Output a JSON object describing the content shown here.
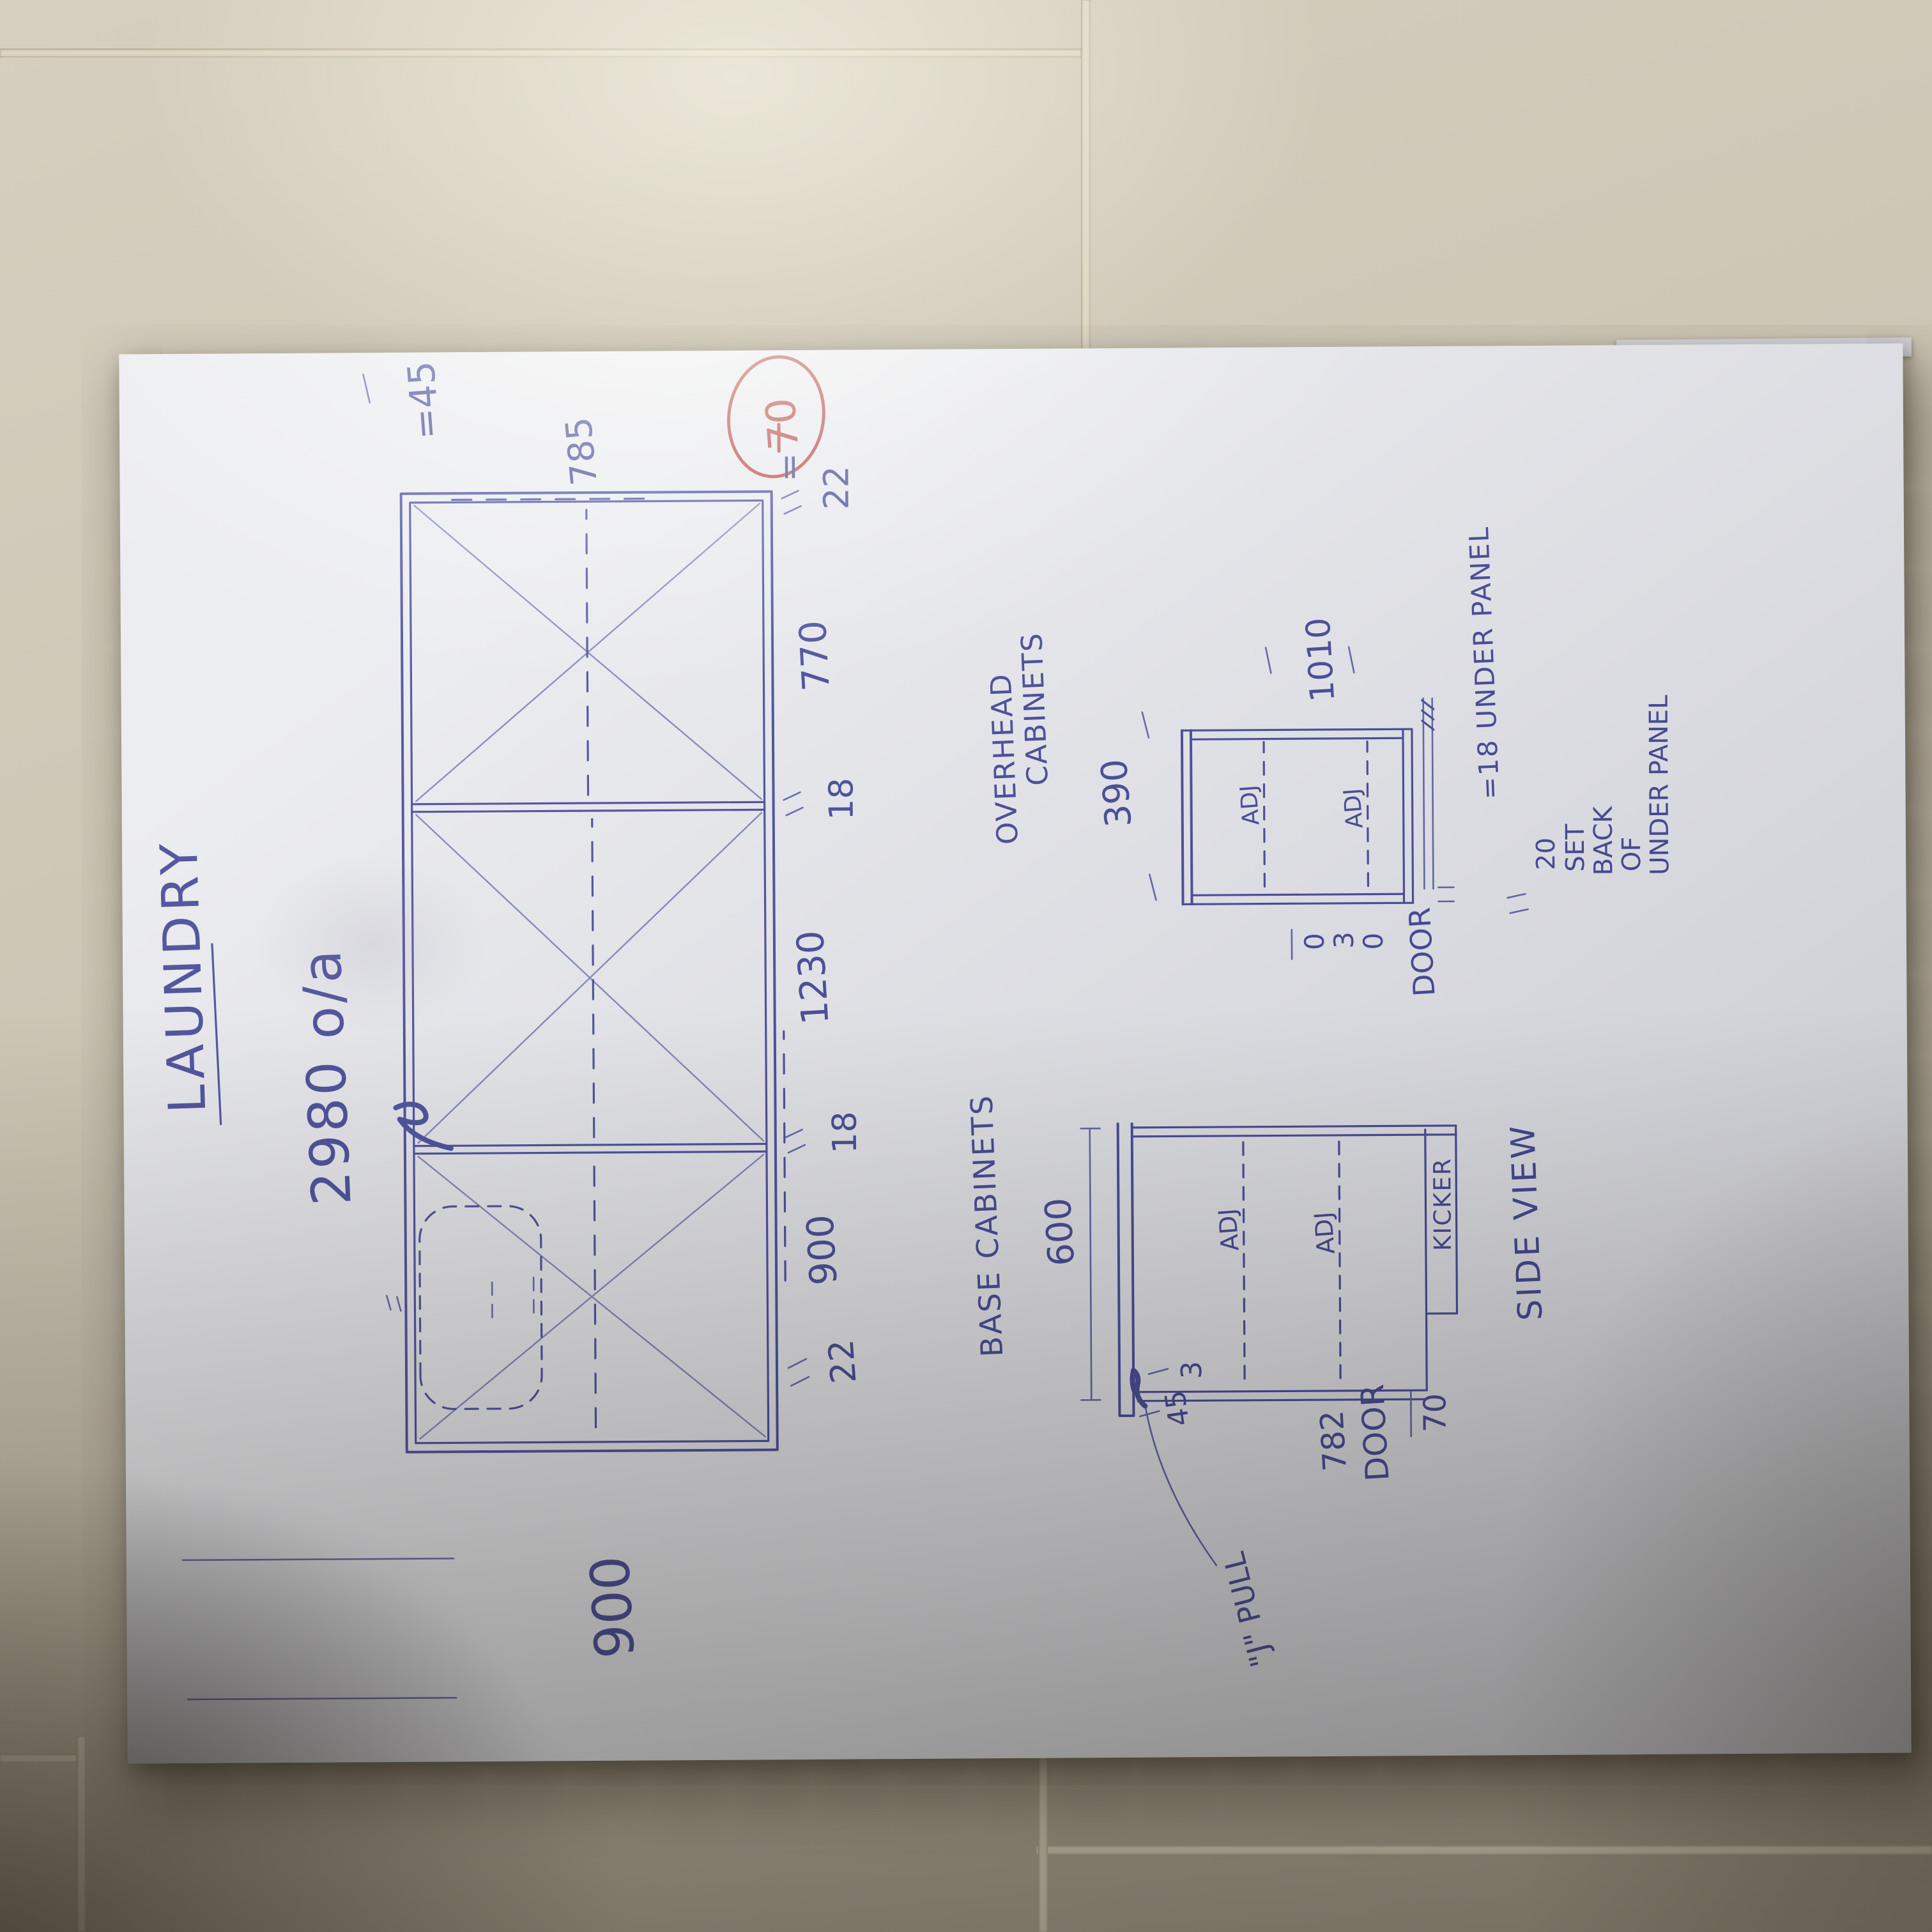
{
  "colors": {
    "ink": "#3d4296",
    "ink_light": "#7b7fb6",
    "red_pen": "#b5423a"
  },
  "sheet": {
    "title": "LAUNDRY",
    "overall_dim": "2980 o/a",
    "elevation": {
      "height_dim": "900",
      "bench_dim": "=45",
      "door_dim": "785",
      "kicker_eq": "=",
      "kicker_dim": "70",
      "bottom_dims": [
        "22",
        "900",
        "18",
        "1230",
        "18",
        "770",
        "22"
      ]
    },
    "base": {
      "heading": "BASE CABINETS",
      "depth_dim": "600",
      "shelf_label": "ADJ",
      "kicker_label": "KICKER",
      "door_dim": "782",
      "door_label": "DOOR",
      "kicker_dim": "70",
      "bench_dim": "45",
      "gap_dim": "3",
      "pull_label": "\"J\" PULL"
    },
    "overhead": {
      "heading_line1": "OVERHEAD",
      "heading_line2": "CABINETS",
      "depth_dim": "390",
      "height_dim": "1010",
      "shelf_label": "ADJ",
      "door_label": "DOOR",
      "gap_digit_top": "0",
      "gap_digit_mid": "3",
      "gap_digit_bot": "0",
      "under_panel_note": "=18 UNDER PANEL",
      "setback_line1": "20",
      "setback_line2": "SET",
      "setback_line3": "BACK",
      "setback_line4": "OF",
      "setback_line5": "UNDER PANEL"
    },
    "side_view_label": "SIDE VIEW"
  }
}
